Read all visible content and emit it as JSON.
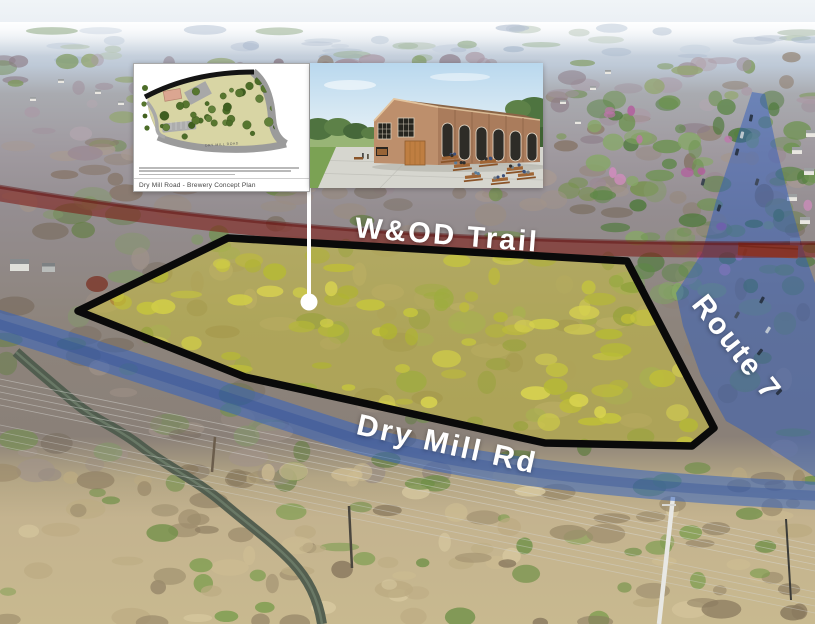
{
  "map": {
    "labels": {
      "trail": "W&OD Trail",
      "road": "Dry Mill Rd",
      "route": "Route 7"
    },
    "parcel_fill_color": "#e2d428",
    "parcel_stroke_color": "#0a0a0a",
    "trail_band_color": "#7e261d",
    "road_band_color": "#2f62c4"
  },
  "inset": {
    "plan_caption": "Dry Mill Road - Brewery Concept Plan",
    "plan_road_label": "DRY MILL ROAD"
  }
}
